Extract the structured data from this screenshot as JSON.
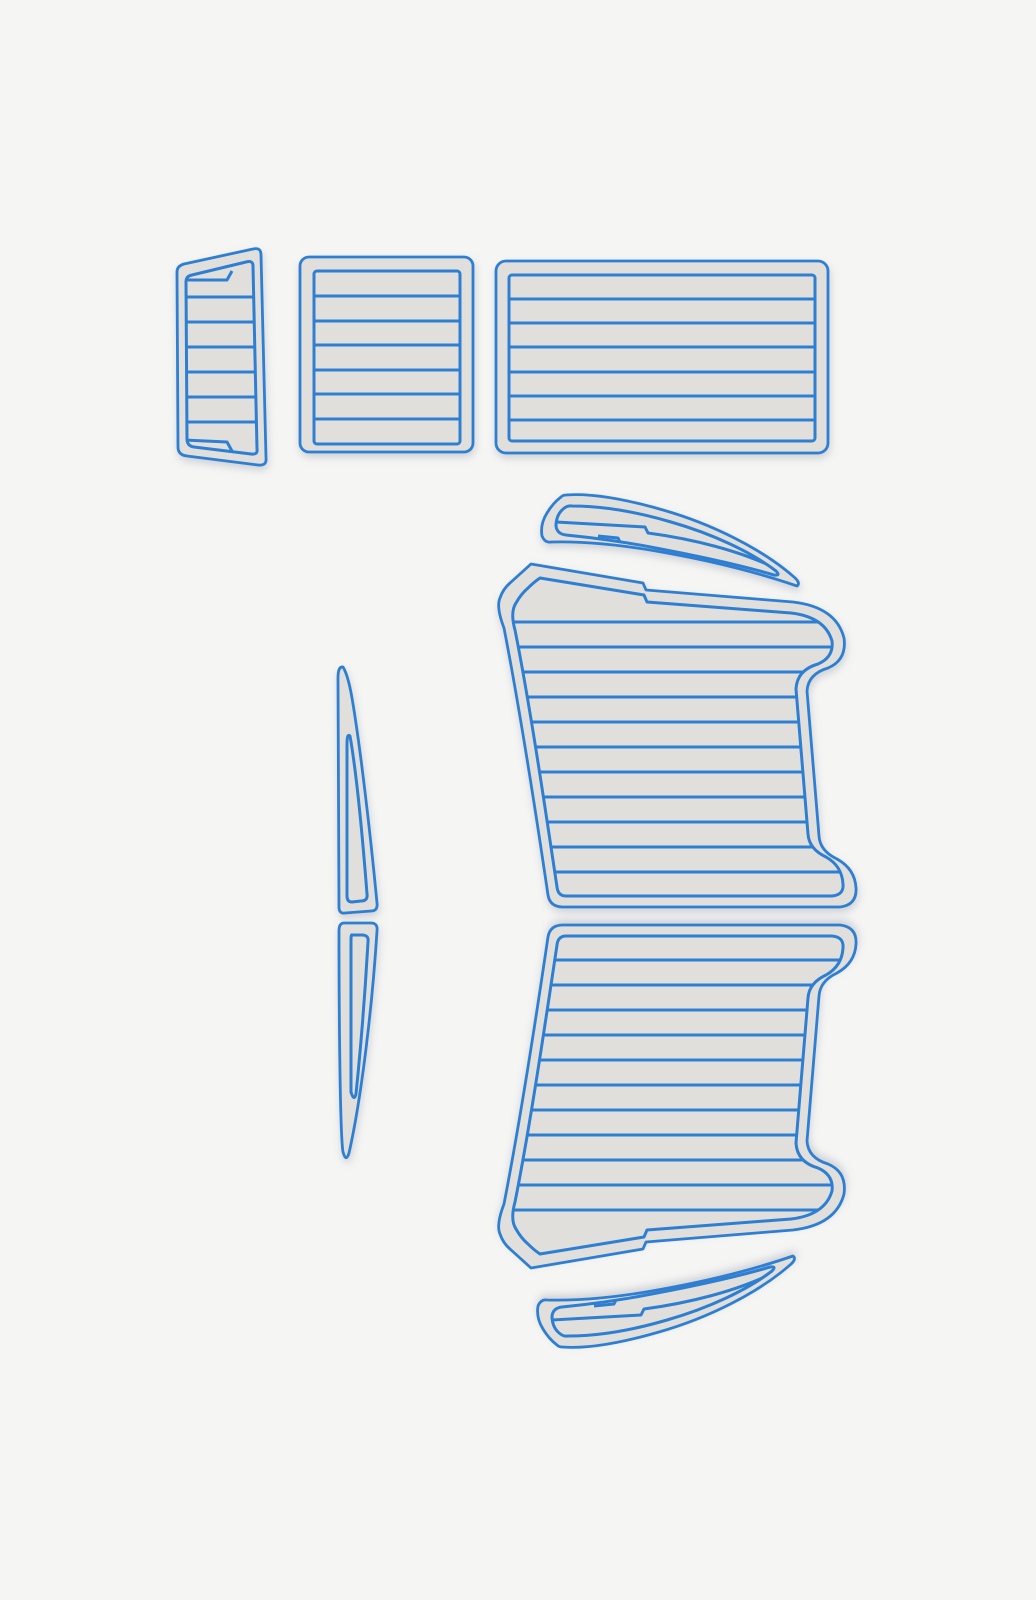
{
  "canvas": {
    "width": 1036,
    "height": 1600,
    "background": "#f5f5f4"
  },
  "colors": {
    "bg": "#f5f5f4",
    "outline": "#2e7fd2",
    "pad_fill": "#e0dfdc",
    "shadow": "rgba(95,105,125,0.25)"
  },
  "pieces": {
    "tapered_pad": {
      "name": "tapered-pad",
      "planks": 7,
      "stripes": {
        "x1": 168,
        "x2": 280,
        "y": [
          297,
          322,
          347,
          372,
          397,
          422
        ]
      }
    },
    "square_pad": {
      "name": "square-pad",
      "planks": 7,
      "stripes": {
        "x1": 296,
        "x2": 478,
        "y": [
          296,
          321,
          345,
          370,
          394,
          419
        ]
      }
    },
    "wide_pad": {
      "name": "wide-rectangular-pad",
      "planks": 7,
      "stripes": {
        "x1": 492,
        "x2": 832,
        "y": [
          299,
          323,
          347,
          372,
          396,
          420
        ]
      }
    },
    "main_deck_upper": {
      "name": "main-deck-pad-upper",
      "planks": 12,
      "stripes": {
        "x1": 488,
        "x2": 870,
        "y": [
          622,
          647,
          672,
          697,
          722,
          747,
          772,
          797,
          822,
          847,
          872
        ]
      }
    },
    "main_deck_lower": {
      "name": "main-deck-pad-lower",
      "planks": 12,
      "mirror_of": "main_deck_upper"
    },
    "trim_upper": {
      "name": "curved-trim-upper",
      "planks": 3
    },
    "trim_lower": {
      "name": "curved-trim-lower",
      "planks": 3,
      "mirror_of": "trim_upper"
    },
    "sliver_upper": {
      "name": "side-strip-upper",
      "planks": 1
    },
    "sliver_lower": {
      "name": "side-strip-lower",
      "planks": 1
    }
  }
}
